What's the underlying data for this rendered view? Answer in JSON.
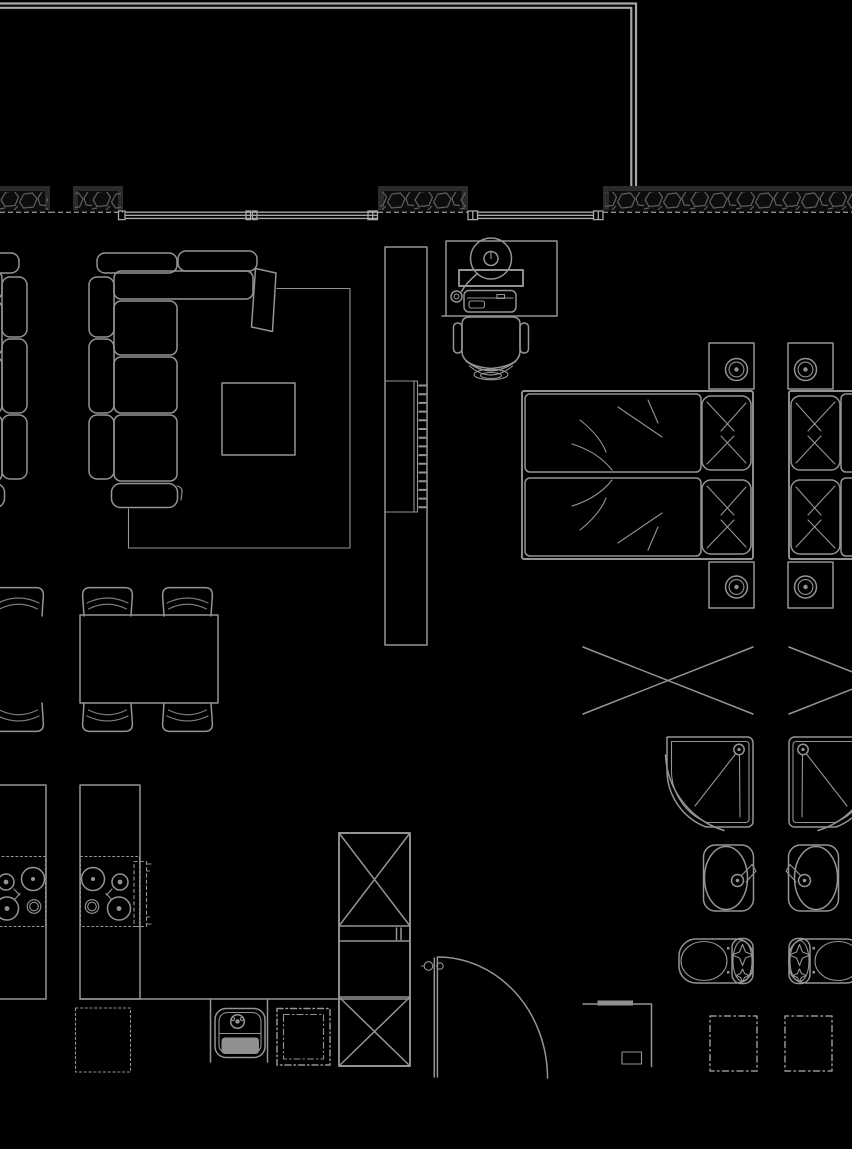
{
  "meta": {
    "type": "architectural-floor-plan",
    "description": "CAD-style apartment floor plan, grey line work on black; central unit fully drawn with mirrored neighbour-unit fragments at left and right edges",
    "visible_text": []
  },
  "canvas": {
    "width": 852,
    "height": 1149
  },
  "colors": {
    "background": "#000000",
    "line": "#949494",
    "line_soft": "#7c7c7c",
    "line_bright": "#a8a8a8",
    "wall_body": "#0d0d0d",
    "wall_cap": "#2b2b2b",
    "stone": "#5e5e5e",
    "solid": "#8f8f8f",
    "dash": "#8a8a8a"
  },
  "architecture": [
    {
      "id": "balcony-rail",
      "label": "balcony / terrace edge (double line)",
      "bbox": [
        0,
        3,
        637,
        184
      ]
    },
    {
      "id": "exterior-wall-left-a",
      "label": "hatched exterior wall segment",
      "bbox": [
        0,
        186,
        50,
        27
      ]
    },
    {
      "id": "exterior-wall-left-b",
      "label": "hatched exterior wall segment",
      "bbox": [
        73,
        186,
        50,
        27
      ]
    },
    {
      "id": "exterior-wall-mid",
      "label": "hatched exterior wall segment",
      "bbox": [
        378,
        186,
        90,
        27
      ]
    },
    {
      "id": "exterior-wall-right",
      "label": "hatched exterior wall segment",
      "bbox": [
        603,
        186,
        249,
        27
      ]
    },
    {
      "id": "window-band-living",
      "label": "triple-line window band, living room",
      "bbox": [
        118,
        211,
        260,
        9
      ]
    },
    {
      "id": "window-band-bedroom",
      "label": "triple-line window band, bedroom",
      "bbox": [
        468,
        211,
        135,
        9
      ]
    },
    {
      "id": "entry-door",
      "label": "door leaf with quarter-circle swing",
      "bbox": [
        421,
        956,
        127,
        122
      ]
    },
    {
      "id": "utility-niche",
      "label": "utility niche with panel box",
      "bbox": [
        583,
        1000,
        69,
        67
      ]
    }
  ],
  "furniture": [
    {
      "id": "sectional-sofa",
      "label": "L-shaped sectional sofa",
      "bbox": [
        88,
        251,
        189,
        258
      ]
    },
    {
      "id": "area-rug",
      "label": "area rug outline",
      "bbox": [
        128,
        288,
        222,
        260
      ]
    },
    {
      "id": "coffee-table",
      "label": "square coffee table",
      "bbox": [
        222,
        383,
        73,
        72
      ]
    },
    {
      "id": "dining-table",
      "label": "dining table",
      "bbox": [
        80,
        615,
        138,
        88
      ]
    },
    {
      "id": "dining-chair-top-left",
      "label": "dining chair",
      "bbox": [
        82,
        586,
        51,
        30
      ]
    },
    {
      "id": "dining-chair-top-right",
      "label": "dining chair",
      "bbox": [
        162,
        586,
        51,
        30
      ]
    },
    {
      "id": "dining-chair-bottom-left",
      "label": "dining chair",
      "bbox": [
        82,
        703,
        51,
        30
      ]
    },
    {
      "id": "dining-chair-bottom-right",
      "label": "dining chair",
      "bbox": [
        162,
        703,
        51,
        30
      ]
    },
    {
      "id": "desk",
      "label": "desk",
      "bbox": [
        446,
        241,
        111,
        75
      ]
    },
    {
      "id": "desk-lamp",
      "label": "desk lamp",
      "bbox": [
        451,
        238,
        61,
        64
      ]
    },
    {
      "id": "laptop",
      "label": "laptop / keyboard",
      "bbox": [
        464,
        290,
        52,
        22
      ]
    },
    {
      "id": "desk-chair",
      "label": "office chair",
      "bbox": [
        453,
        317,
        76,
        63
      ]
    },
    {
      "id": "wardrobe",
      "label": "tall wardrobe",
      "bbox": [
        385,
        247,
        42,
        398
      ]
    },
    {
      "id": "closet-hanger-rail",
      "label": "hanger rail with clothes hangers",
      "bbox": [
        414,
        381,
        14,
        131
      ]
    },
    {
      "id": "double-bed",
      "label": "double bed, two mattresses",
      "bbox": [
        522,
        391,
        231,
        168
      ]
    },
    {
      "id": "pillow-upper",
      "label": "pillow",
      "bbox": [
        702,
        396,
        49,
        74
      ]
    },
    {
      "id": "pillow-lower",
      "label": "pillow",
      "bbox": [
        702,
        480,
        49,
        74
      ]
    },
    {
      "id": "nightstand-upper",
      "label": "nightstand",
      "bbox": [
        709,
        343,
        45,
        46
      ]
    },
    {
      "id": "table-lamp-upper",
      "label": "round table lamp",
      "bbox": [
        725,
        358,
        23,
        23
      ]
    },
    {
      "id": "nightstand-lower",
      "label": "nightstand",
      "bbox": [
        709,
        562,
        45,
        46
      ]
    },
    {
      "id": "table-lamp-lower",
      "label": "round table lamp",
      "bbox": [
        725,
        576,
        23,
        23
      ]
    },
    {
      "id": "storage-cross",
      "label": "built-in storage marked with X",
      "bbox": [
        583,
        646,
        170,
        69
      ]
    },
    {
      "id": "shower-tray",
      "label": "corner shower tray with drain",
      "bbox": [
        666,
        736,
        88,
        92
      ]
    },
    {
      "id": "washbasin",
      "label": "oval washbasin with tap",
      "bbox": [
        703,
        843,
        51,
        68
      ]
    },
    {
      "id": "toilet",
      "label": "toilet with cistern",
      "bbox": [
        679,
        938,
        74,
        46
      ]
    },
    {
      "id": "washing-machine",
      "label": "washing machine (dashed)",
      "bbox": [
        710,
        1016,
        47,
        55
      ]
    },
    {
      "id": "kitchen-counter",
      "label": "kitchen counter strip",
      "bbox": [
        80,
        785,
        60,
        214
      ]
    },
    {
      "id": "cooktop",
      "label": "4-burner cooktop",
      "bbox": [
        80,
        856,
        60,
        71
      ]
    },
    {
      "id": "extractor-guide",
      "label": "dashed extractor guide",
      "bbox": [
        134,
        861,
        13,
        66
      ]
    },
    {
      "id": "under-counter-appliance",
      "label": "under-counter appliance (dashed)",
      "bbox": [
        75,
        1008,
        56,
        64
      ]
    },
    {
      "id": "kitchen-base-run",
      "label": "kitchen base cabinet run",
      "bbox": [
        80,
        999,
        330,
        67
      ]
    },
    {
      "id": "kitchen-sink",
      "label": "kitchen sink with drainer",
      "bbox": [
        210,
        999,
        58,
        63
      ]
    },
    {
      "id": "built-in-oven",
      "label": "built-in appliance (dash-dot)",
      "bbox": [
        277,
        1008,
        53,
        57
      ]
    },
    {
      "id": "tall-cabinet-fridge",
      "label": "tall cabinet column with X boxes",
      "bbox": [
        339,
        833,
        71,
        233
      ]
    }
  ],
  "neighbor_fragments": [
    {
      "id": "left-unit-sofa",
      "label": "mirrored sofa fragment",
      "bbox": [
        0,
        251,
        28,
        257
      ]
    },
    {
      "id": "left-unit-chair-top",
      "label": "mirrored dining chair",
      "bbox": [
        0,
        586,
        44,
        30
      ]
    },
    {
      "id": "left-unit-chair-bottom",
      "label": "mirrored dining chair",
      "bbox": [
        0,
        703,
        44,
        30
      ]
    },
    {
      "id": "left-unit-counter",
      "label": "mirrored kitchen counter",
      "bbox": [
        0,
        785,
        46,
        214
      ]
    },
    {
      "id": "left-unit-cooktop",
      "label": "mirrored cooktop",
      "bbox": [
        0,
        856,
        46,
        71
      ]
    },
    {
      "id": "right-unit-bed",
      "label": "mirrored bed fragment",
      "bbox": [
        789,
        391,
        63,
        168
      ]
    },
    {
      "id": "right-unit-nightstand-upper",
      "label": "mirrored nightstand",
      "bbox": [
        788,
        343,
        45,
        46
      ]
    },
    {
      "id": "right-unit-nightstand-lower",
      "label": "mirrored nightstand",
      "bbox": [
        788,
        562,
        45,
        46
      ]
    },
    {
      "id": "right-unit-storage-cross",
      "label": "mirrored X storage fragment",
      "bbox": [
        789,
        646,
        63,
        69
      ]
    },
    {
      "id": "right-unit-shower",
      "label": "mirrored shower tray",
      "bbox": [
        788,
        736,
        64,
        92
      ]
    },
    {
      "id": "right-unit-washbasin",
      "label": "mirrored washbasin",
      "bbox": [
        788,
        843,
        51,
        68
      ]
    },
    {
      "id": "right-unit-toilet",
      "label": "mirrored toilet",
      "bbox": [
        789,
        938,
        63,
        46
      ]
    },
    {
      "id": "right-unit-washing-machine",
      "label": "mirrored washing machine",
      "bbox": [
        785,
        1016,
        47,
        55
      ]
    }
  ]
}
